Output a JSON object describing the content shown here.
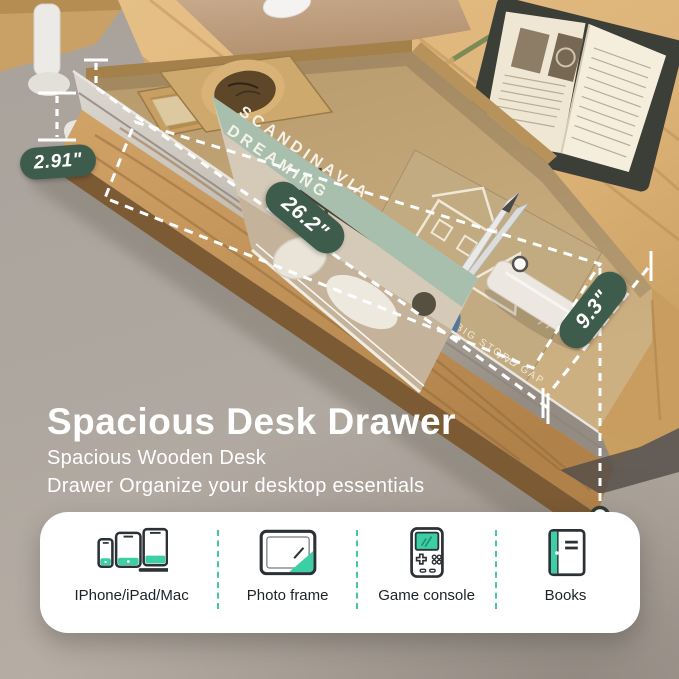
{
  "measurements": {
    "height": "2.91\"",
    "width": "26.2\"",
    "depth": "9.3\""
  },
  "headline": {
    "title": "Spacious Desk Drawer",
    "subtitle_line1": "Spacious Wooden Desk",
    "subtitle_line2": "Drawer Organize your desktop essentials"
  },
  "features": {
    "items": [
      {
        "label": "IPhone/iPad/Mac",
        "icon": "devices-icon"
      },
      {
        "label": "Photo frame",
        "icon": "photo-frame-icon"
      },
      {
        "label": "Game console",
        "icon": "game-console-icon"
      },
      {
        "label": "Books",
        "icon": "books-icon"
      }
    ]
  },
  "scene": {
    "magazine": {
      "title_line1": "SCANDINAVIA",
      "title_line2": "DREAMING"
    },
    "envelope": {
      "text": "TO BIG STORE GAP"
    }
  },
  "colors": {
    "badge_green": "#3d5c4b",
    "accent_teal": "#3ccfa5",
    "card_bg": "#ffffff",
    "label_color": "#1d2226",
    "annotation_white": "#ffffff"
  }
}
